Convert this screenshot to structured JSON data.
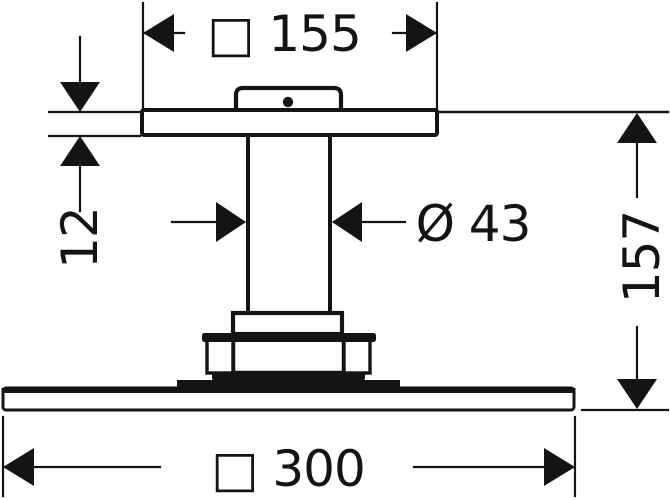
{
  "drawing": {
    "type": "technical-dimension-drawing",
    "subject": "ceiling-mounted overhead shower, side elevation",
    "background_color": "#ffffff",
    "line_color": "#141414",
    "dimensions": [
      {
        "id": "top-width",
        "label": "□ 155",
        "symbol": "□",
        "value": 155,
        "orientation": "horizontal"
      },
      {
        "id": "plate-thickness",
        "label": "12",
        "symbol": "",
        "value": 12,
        "orientation": "vertical"
      },
      {
        "id": "pipe-diameter",
        "label": "Ø 43",
        "symbol": "Ø",
        "value": 43,
        "orientation": "horizontal"
      },
      {
        "id": "overall-height",
        "label": "157",
        "symbol": "",
        "value": 157,
        "orientation": "vertical"
      },
      {
        "id": "bottom-width",
        "label": "□ 300",
        "symbol": "□",
        "value": 300,
        "orientation": "horizontal"
      }
    ]
  }
}
